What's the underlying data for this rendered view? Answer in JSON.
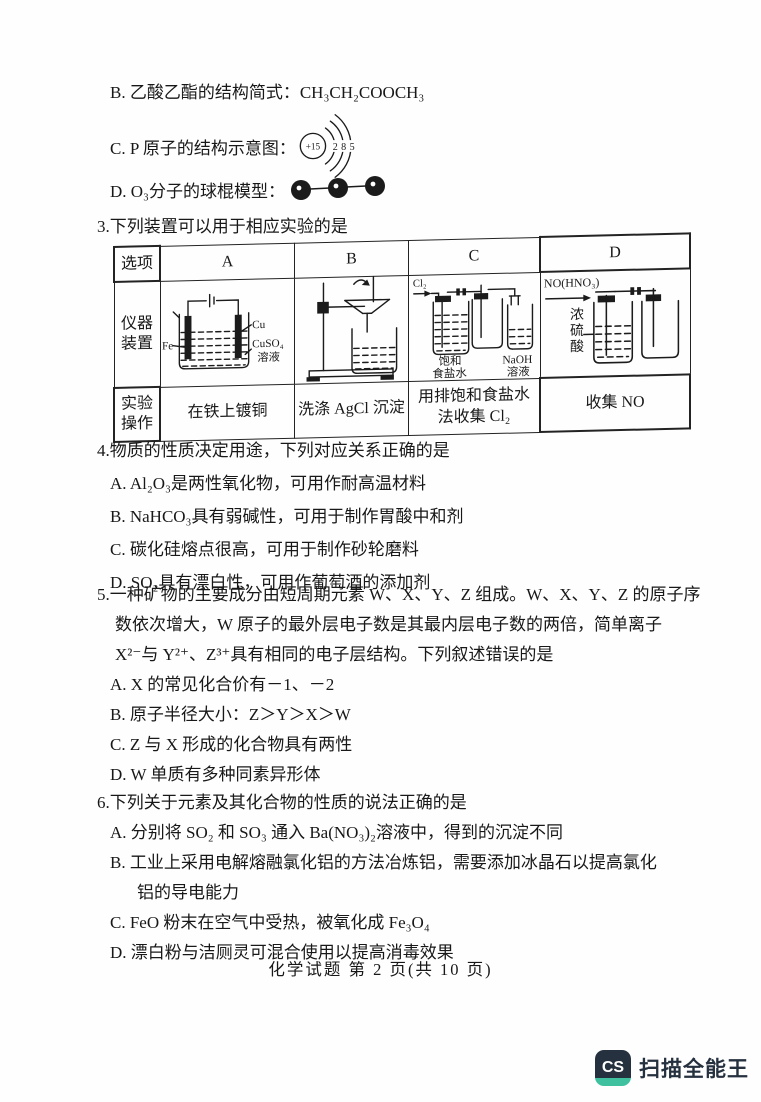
{
  "q2": {
    "option_b": "B. 乙酸乙酯的结构简式：CH₃CH₂COOCH₃",
    "option_c_prefix": "C. P 原子的结构示意图：",
    "atom_diagram": {
      "nucleus": "+15",
      "shell_counts": [
        "2",
        "8",
        "5"
      ]
    },
    "option_d_prefix": "D. O₃分子的球棍模型："
  },
  "q3": {
    "stem": "3.下列装置可以用于相应实验的是",
    "table": {
      "corner_header": "选项",
      "column_headers": [
        "A",
        "B",
        "C",
        "D"
      ],
      "apparatus_row_label": "仪器装置",
      "operation_row_label": "实验操作",
      "apparatus_labels": {
        "a": {
          "left_electrode": "Fe",
          "right_electrode": "Cu",
          "solution_line1": "CuSO₄",
          "solution_line2": "溶液"
        },
        "c": {
          "gas_in": "Cl₂",
          "bottle1_line1": "饱和",
          "bottle1_line2": "食盐水",
          "bottle3_line1": "NaOH",
          "bottle3_line2": "溶液"
        },
        "d": {
          "gas_in": "NO(HNO₃)",
          "bottle1_label": "浓硫酸"
        }
      },
      "operations": {
        "a": "在铁上镀铜",
        "b": "洗涤 AgCl 沉淀",
        "c_line1": "用排饱和食盐水",
        "c_line2": "法收集 Cl₂",
        "d": "收集 NO"
      }
    }
  },
  "q4": {
    "stem": "4.物质的性质决定用途，下列对应关系正确的是",
    "options": [
      "A. Al₂O₃是两性氧化物，可用作耐高温材料",
      "B. NaHCO₃具有弱碱性，可用于制作胃酸中和剂",
      "C. 碳化硅熔点很高，可用于制作砂轮磨料",
      "D. SO₂具有漂白性，可用作葡萄酒的添加剂"
    ]
  },
  "q5": {
    "stem_line1": "5.一种矿物的主要成分由短周期元素 W、X、Y、Z 组成。W、X、Y、Z 的原子序",
    "stem_line2": "数依次增大，W 原子的最外层电子数是其最内层电子数的两倍，简单离子",
    "stem_line3": "X²⁻与 Y²⁺、Z³⁺具有相同的电子层结构。下列叙述错误的是",
    "options": [
      "A. X 的常见化合价有－1、－2",
      "B. 原子半径大小：Z＞Y＞X＞W",
      "C. Z 与 X 形成的化合物具有两性",
      "D. W 单质有多种同素异形体"
    ]
  },
  "q6": {
    "stem": "6.下列关于元素及其化合物的性质的说法正确的是",
    "option_a": "A. 分别将 SO₂ 和 SO₃ 通入 Ba(NO₃)₂溶液中，得到的沉淀不同",
    "option_b_line1": "B. 工业上采用电解熔融氯化铝的方法冶炼铝，需要添加冰晶石以提高氯化",
    "option_b_line2": "铝的导电能力",
    "option_c": "C. FeO 粉末在空气中受热，被氧化成 Fe₃O₄",
    "option_d": "D. 漂白粉与洁厕灵可混合使用以提高消毒效果"
  },
  "footer": {
    "page_label": "化学试题 第 2 页(共 10 页)"
  },
  "watermark": {
    "logo_text": "CS",
    "app_name": "扫描全能王",
    "navy": "#25313e",
    "teal": "#3fc1a0"
  }
}
